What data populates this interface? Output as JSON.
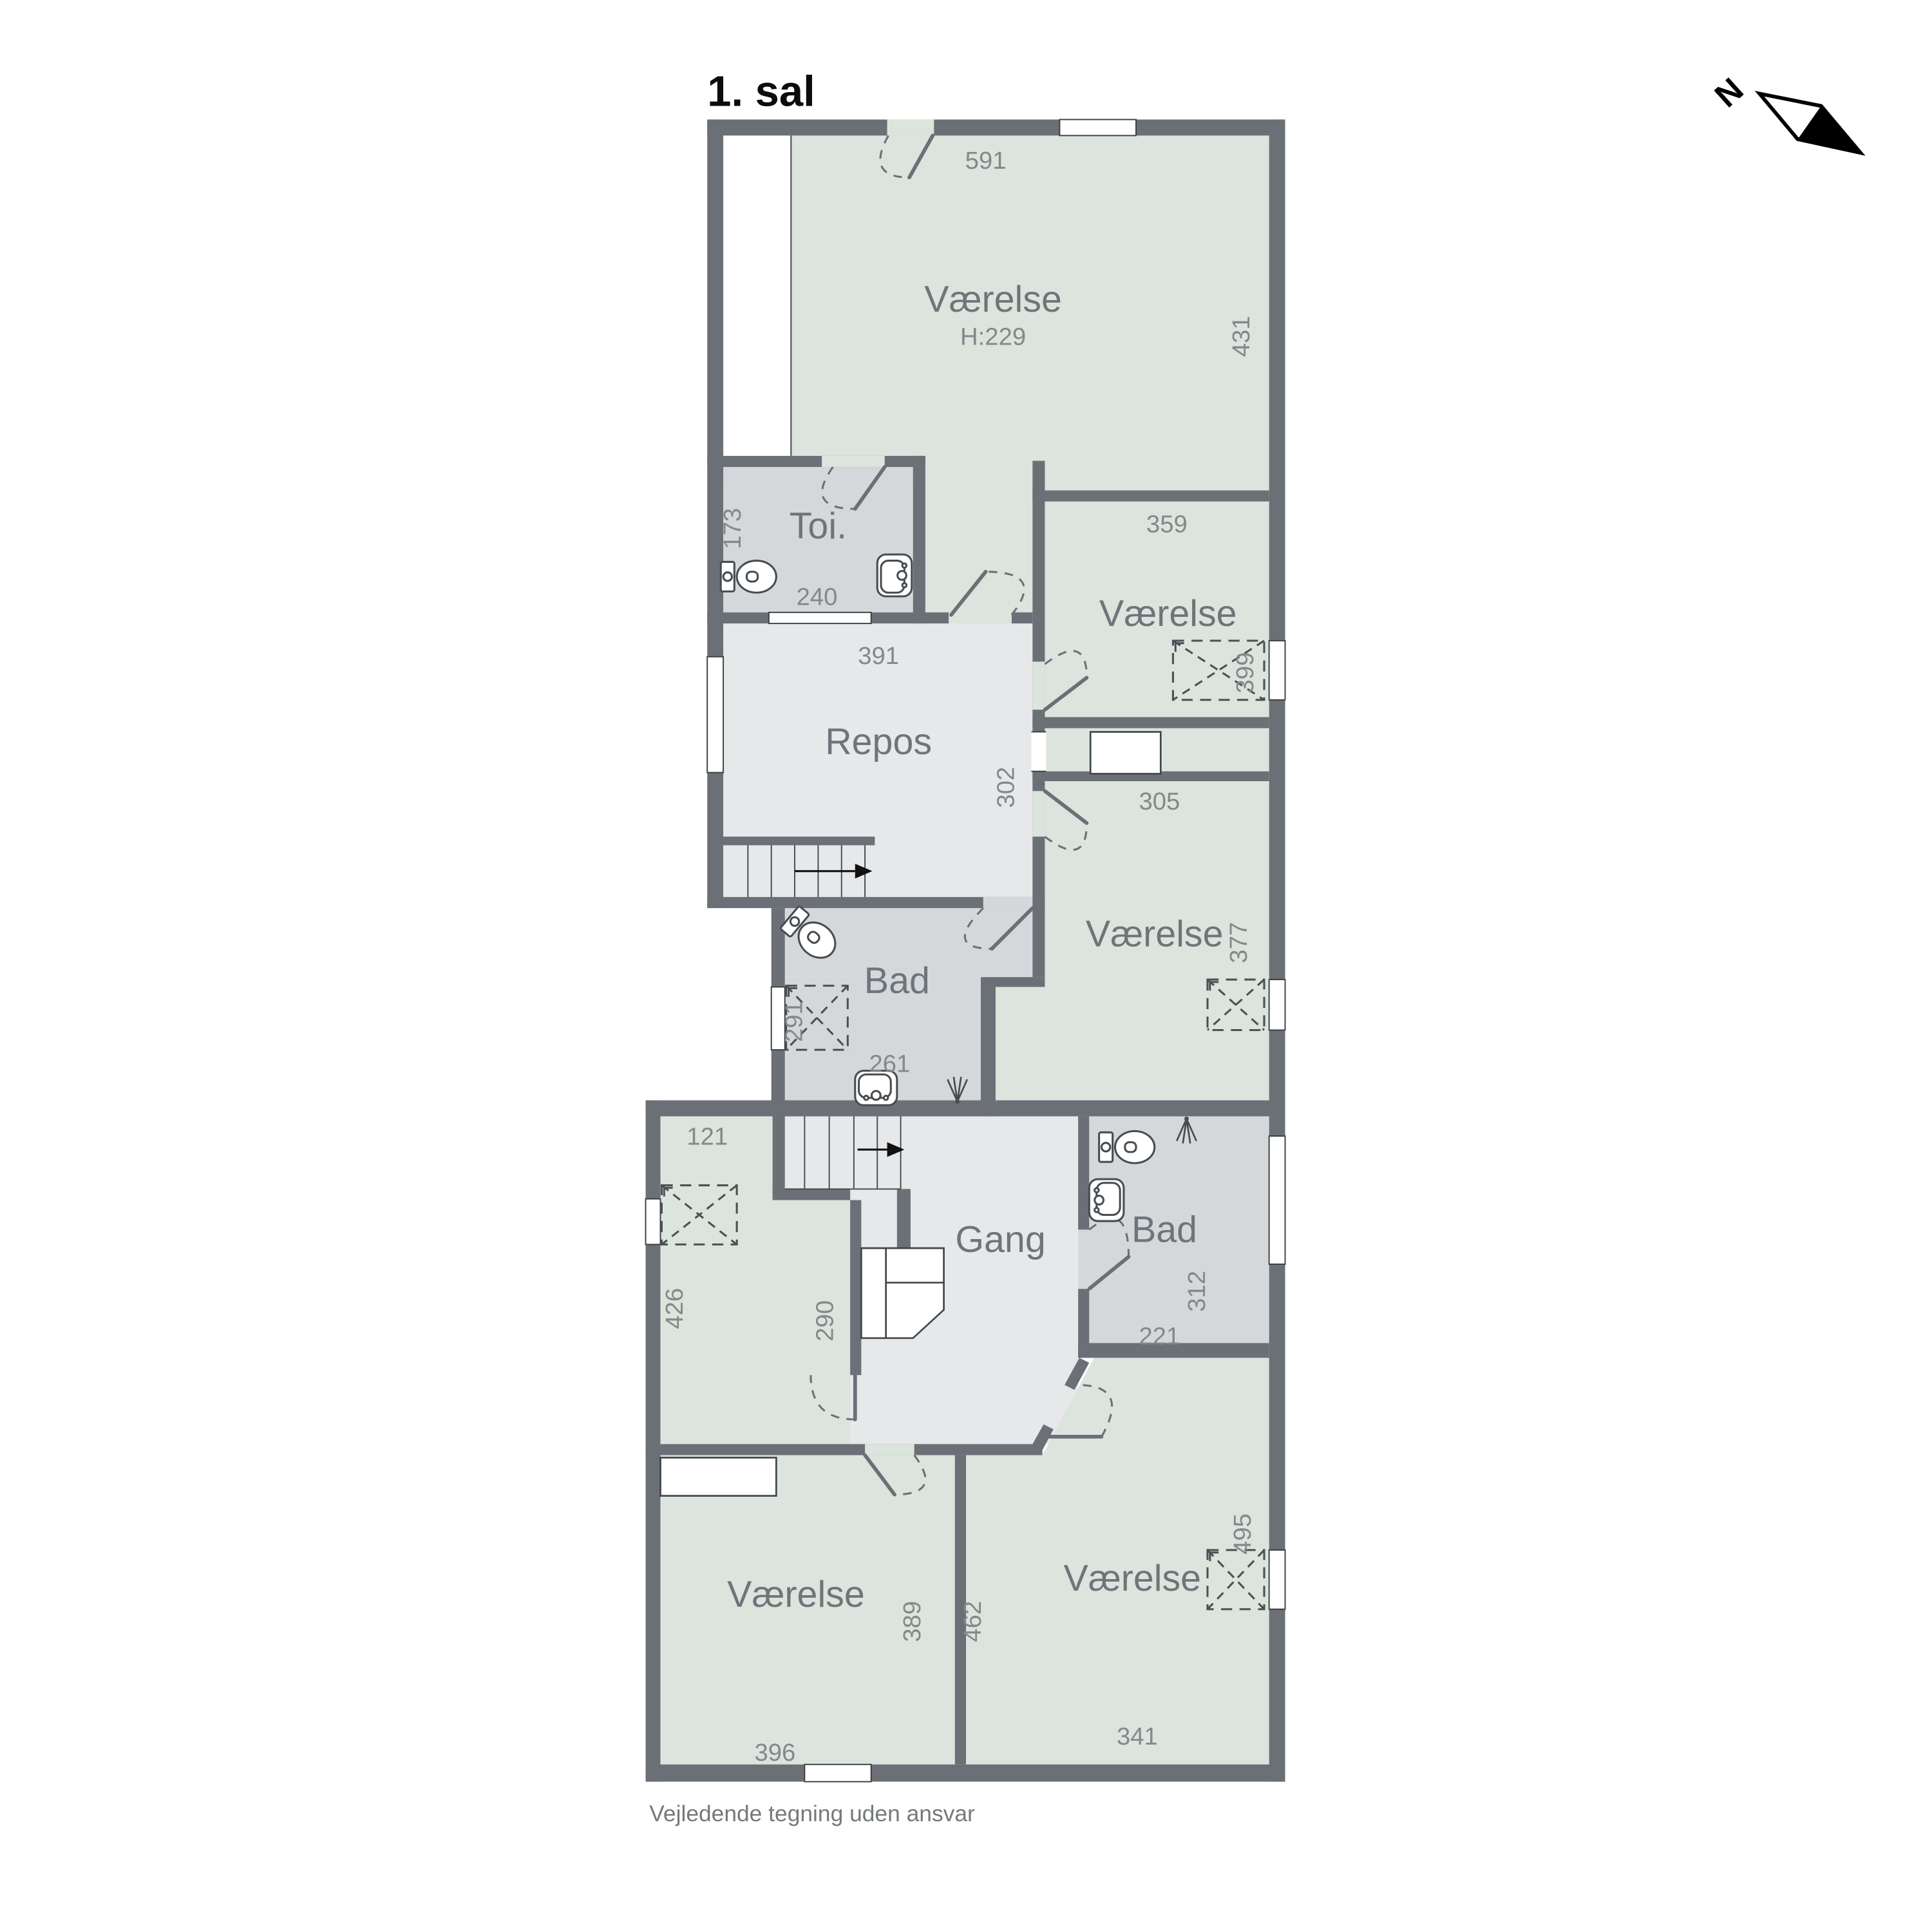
{
  "title": "1. sal",
  "footer": "Vejledende tegning uden ansvar",
  "compass": {
    "north": "N"
  },
  "colors": {
    "wall": "#6b7076",
    "room_green": "#dbe4dd",
    "room_gray": "#d5d8da",
    "hall_gray": "#e6e8e9",
    "dim_text": "#83888b",
    "label_text": "#6e757a"
  },
  "rooms": {
    "vaerelse_top": {
      "label": "Værelse",
      "ceiling": "H:229",
      "width": "591",
      "depth": "431"
    },
    "toi": {
      "label": "Toi.",
      "depth": "173",
      "width": "240"
    },
    "repos": {
      "label": "Repos",
      "width": "391",
      "depth": "302"
    },
    "vaerelse_ne": {
      "label": "Værelse",
      "width": "359",
      "skylight": "399"
    },
    "vaerelse_e": {
      "label": "Værelse",
      "width": "305",
      "depth": "377"
    },
    "bad_upper": {
      "label": "Bad",
      "skylight": "291",
      "width": "261"
    },
    "vaerelse_w": {
      "width": "121",
      "depth": "426"
    },
    "gang": {
      "label": "Gang",
      "depth": "290"
    },
    "bad_lower": {
      "label": "Bad",
      "depth": "312",
      "width": "221"
    },
    "vaerelse_sw": {
      "label": "Værelse",
      "depth": "389",
      "width": "396"
    },
    "vaerelse_se": {
      "label": "Værelse",
      "left": "462",
      "skylight": "495",
      "width": "341"
    }
  }
}
